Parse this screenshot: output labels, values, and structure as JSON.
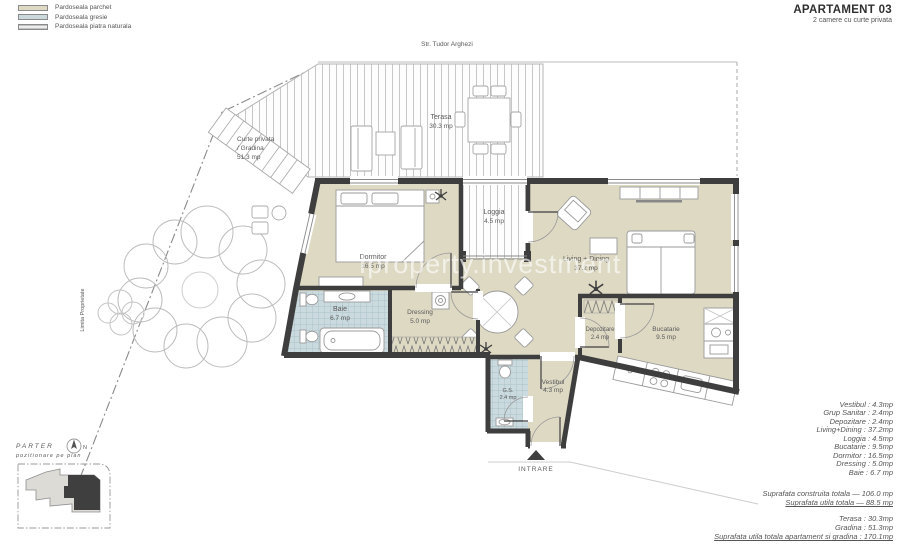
{
  "header": {
    "title": "APARTAMENT 03",
    "subtitle": "2 camere cu curte privata"
  },
  "legend": {
    "items": [
      {
        "label": "Pardoseala parchet",
        "color": "#ded9c3"
      },
      {
        "label": "Pardoseala gresie",
        "color": "#ccd9dc"
      },
      {
        "label": "Pardoseala piatra naturala",
        "color": "#d9d9d5"
      }
    ]
  },
  "colors": {
    "wall": "#3e3e3e",
    "parquet": "#ded9c3",
    "tile": "#ccdade"
  },
  "plan": {
    "street": "Str. Tudor Arghezi",
    "property_line": "Limita Proprietate",
    "entrance": "INTRARE",
    "watermark": "Iproperty.investment",
    "rooms": {
      "terasa": {
        "name": "Terasa",
        "area": "30.3 mp"
      },
      "gradina": {
        "line1": "Curte privata",
        "line2": "/ Gradina",
        "area": "51.3 mp"
      },
      "dormitor": {
        "name": "Dormitor",
        "area": "16.5 mp"
      },
      "loggia": {
        "name": "Loggia",
        "area": "4.5 mp"
      },
      "living": {
        "name": "Living + Dining",
        "area": "37.2 mp"
      },
      "baie": {
        "name": "Baie",
        "area": "6.7 mp"
      },
      "dressing": {
        "name": "Dressing",
        "area": "5.0 mp"
      },
      "depozitare": {
        "name": "Depozitare",
        "area": "2.4 mp"
      },
      "bucatarie": {
        "name": "Bucatarie",
        "area": "9.5 mp"
      },
      "vestibul": {
        "name": "Vestibul",
        "area": "4.3 mp"
      },
      "grup_sanitar": {
        "name": "G.S.",
        "area": "2.4 mp"
      }
    }
  },
  "keyplan": {
    "title": "PARTER",
    "subtitle": "pozitionare pe plan",
    "north": "N"
  },
  "summary": {
    "rooms": [
      {
        "label": "Vestibul",
        "value": "4.3mp"
      },
      {
        "label": "Grup Sanitar",
        "value": "2.4mp"
      },
      {
        "label": "Depozitare",
        "value": "2.4mp"
      },
      {
        "label": "Living+Dining",
        "value": "37.2mp"
      },
      {
        "label": "Loggia",
        "value": "4.5mp"
      },
      {
        "label": "Bucatarie",
        "value": "9.5mp"
      },
      {
        "label": "Dormitor",
        "value": "16.5mp"
      },
      {
        "label": "Dressing",
        "value": "5.0mp"
      },
      {
        "label": "Baie",
        "value": "6.7 mp"
      }
    ],
    "totals": [
      {
        "label": "Suprafata construita totala",
        "value": "106.0 mp"
      },
      {
        "label": "Suprafata utila totala",
        "value": "88.5 mp"
      }
    ],
    "exterior": [
      {
        "label": "Terasa",
        "value": "30.3mp"
      },
      {
        "label": "Gradina",
        "value": "51.3mp"
      }
    ],
    "grand_total": {
      "label": "Suprafata utila totala apartament si gradina",
      "value": "170.1mp"
    }
  }
}
